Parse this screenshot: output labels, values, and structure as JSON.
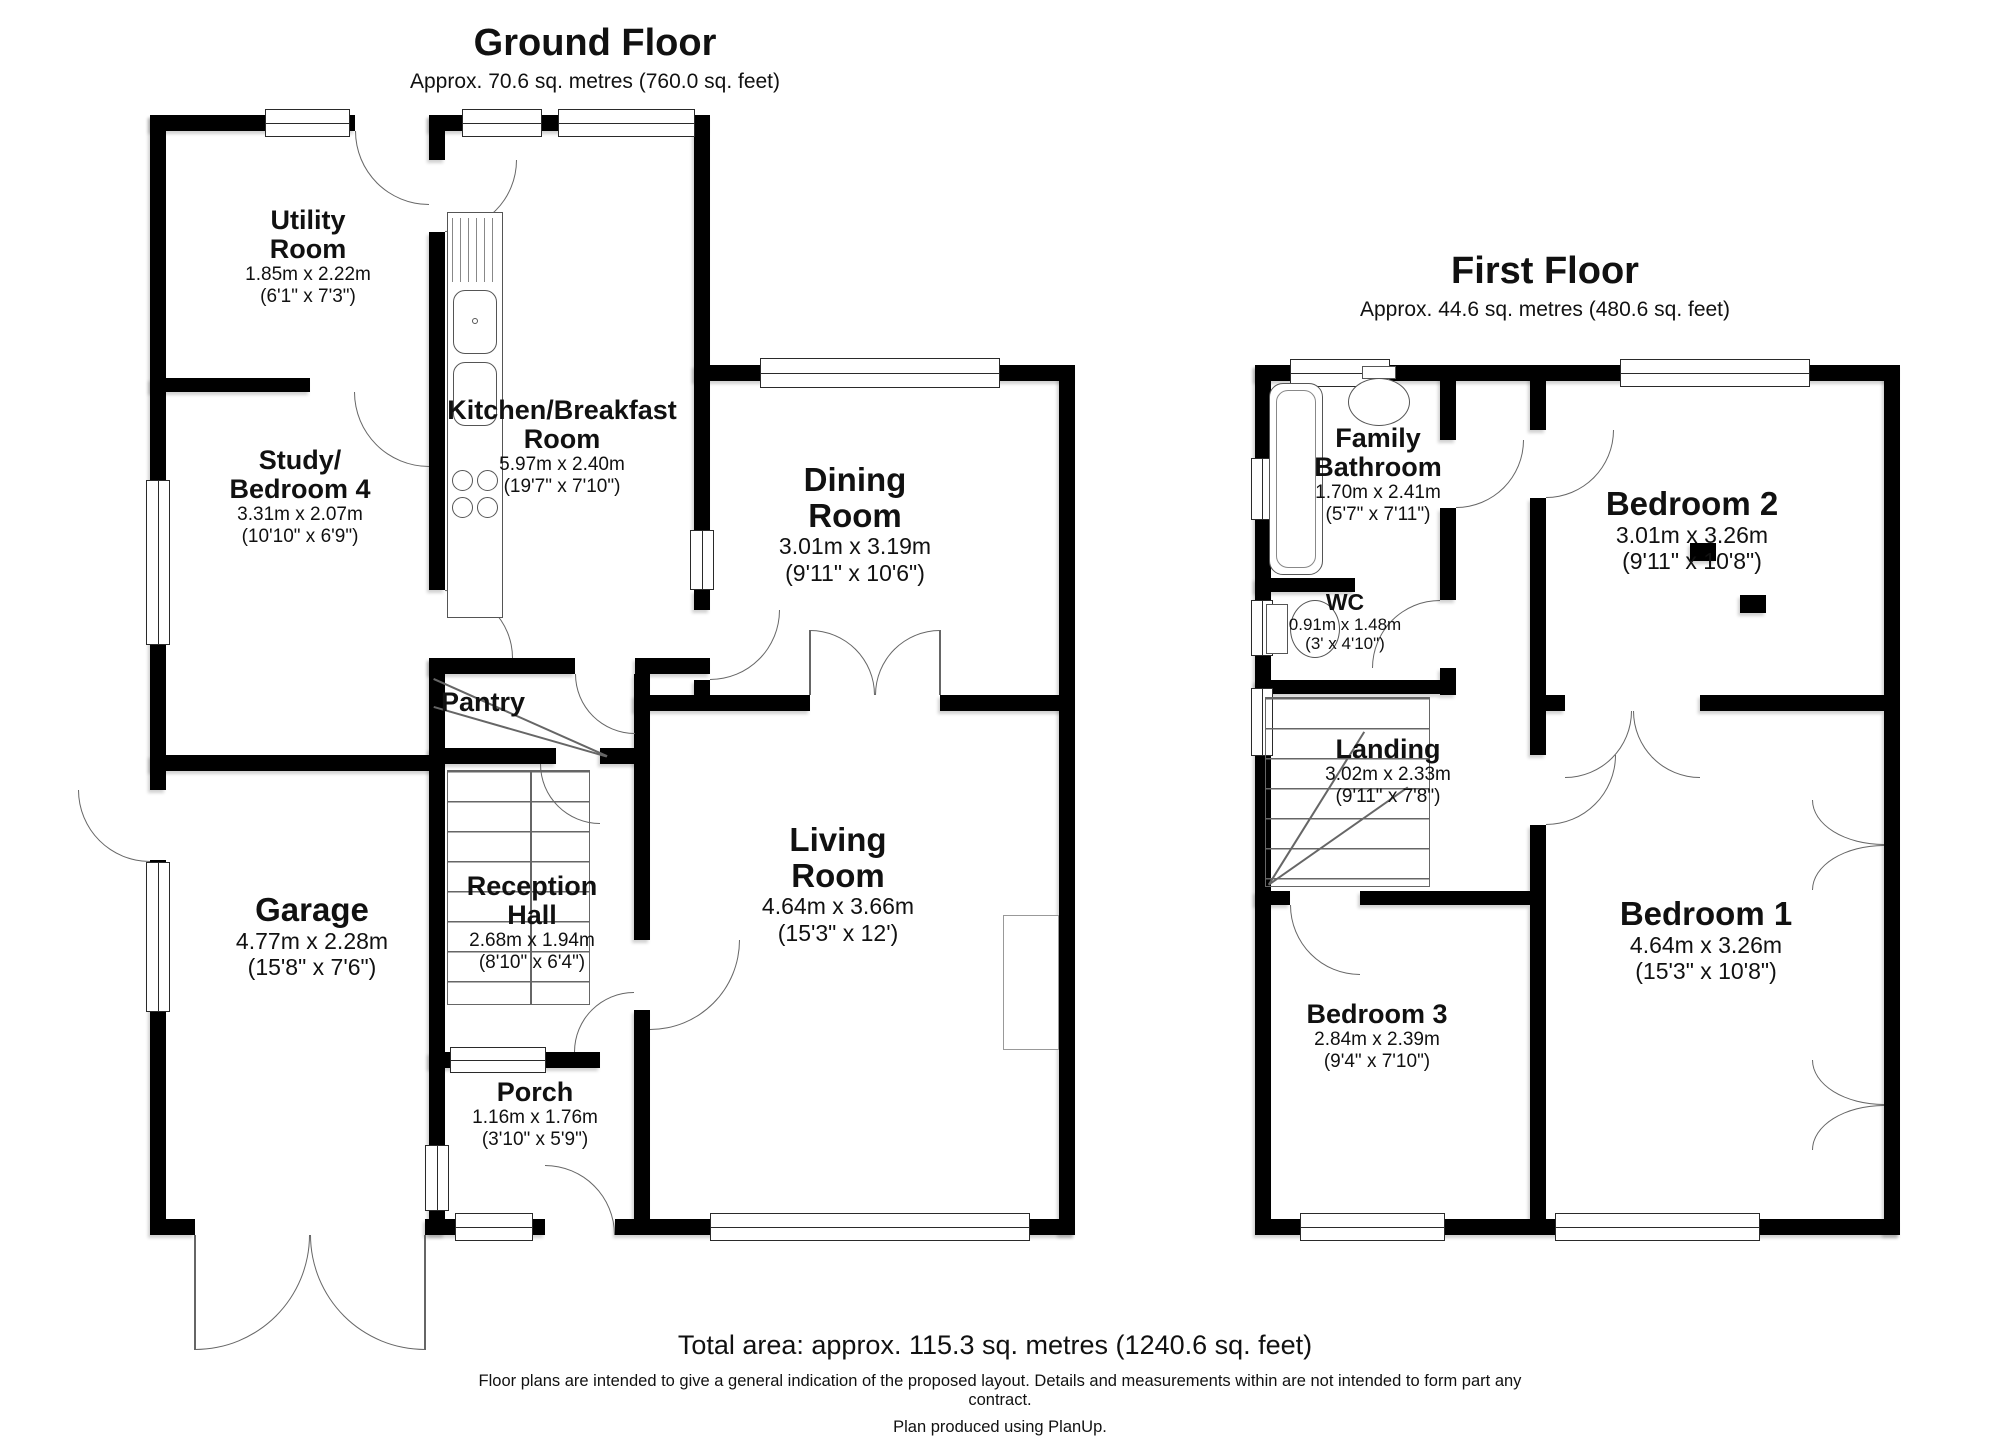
{
  "ground_floor": {
    "title": "Ground Floor",
    "subtitle": "Approx. 70.6 sq. metres (760.0 sq. feet)",
    "rooms": {
      "utility": {
        "name": "Utility\nRoom",
        "metric": "1.85m x 2.22m",
        "imperial": "(6'1\" x 7'3\")"
      },
      "study": {
        "name": "Study/\nBedroom 4",
        "metric": "3.31m x 2.07m",
        "imperial": "(10'10\" x 6'9\")"
      },
      "kitchen": {
        "name": "Kitchen/Breakfast\nRoom",
        "metric": "5.97m x 2.40m",
        "imperial": "(19'7\" x 7'10\")"
      },
      "dining": {
        "name": "Dining\nRoom",
        "metric": "3.01m x 3.19m",
        "imperial": "(9'11\" x 10'6\")"
      },
      "pantry": {
        "name": "Pantry"
      },
      "reception": {
        "name": "Reception\nHall",
        "metric": "2.68m x 1.94m",
        "imperial": "(8'10\" x 6'4\")"
      },
      "garage": {
        "name": "Garage",
        "metric": "4.77m x 2.28m",
        "imperial": "(15'8\" x 7'6\")"
      },
      "living": {
        "name": "Living\nRoom",
        "metric": "4.64m x 3.66m",
        "imperial": "(15'3\" x 12')"
      },
      "porch": {
        "name": "Porch",
        "metric": "1.16m x 1.76m",
        "imperial": "(3'10\" x 5'9\")"
      }
    }
  },
  "first_floor": {
    "title": "First Floor",
    "subtitle": "Approx. 44.6 sq. metres (480.6 sq. feet)",
    "rooms": {
      "bathroom": {
        "name": "Family\nBathroom",
        "metric": "1.70m x 2.41m",
        "imperial": "(5'7\" x 7'11\")"
      },
      "wc": {
        "name": "WC",
        "metric": "0.91m x 1.48m",
        "imperial": "(3' x 4'10\")"
      },
      "bedroom2": {
        "name": "Bedroom 2",
        "metric": "3.01m x 3.26m",
        "imperial": "(9'11\" x 10'8\")"
      },
      "landing": {
        "name": "Landing",
        "metric": "3.02m x 2.33m",
        "imperial": "(9'11\" x 7'8\")"
      },
      "bedroom3": {
        "name": "Bedroom 3",
        "metric": "2.84m x 2.39m",
        "imperial": "(9'4\" x 7'10\")"
      },
      "bedroom1": {
        "name": "Bedroom 1",
        "metric": "4.64m x 3.26m",
        "imperial": "(15'3\" x 10'8\")"
      }
    }
  },
  "footer": {
    "total_area": "Total area: approx. 115.3 sq. metres (1240.6 sq. feet)",
    "disclaimer": "Floor plans are intended to give a general indication of the proposed layout. Details and measurements within are not intended to form part any\ncontract.",
    "credit": "Plan produced using PlanUp."
  }
}
